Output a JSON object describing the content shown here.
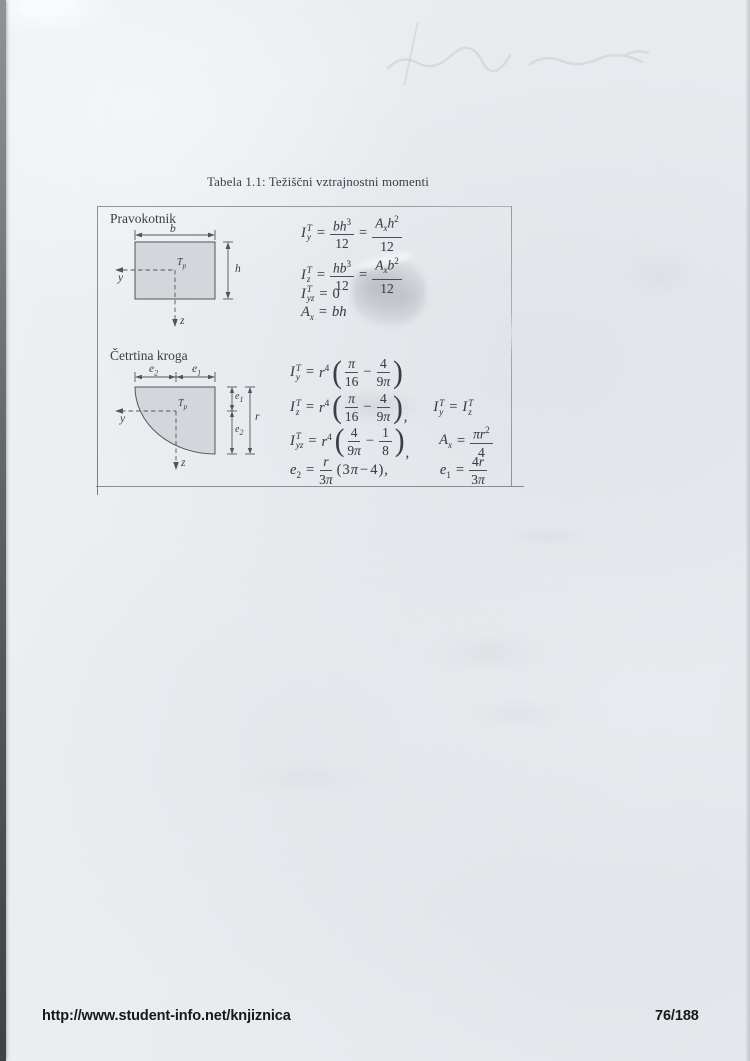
{
  "page": {
    "title": "Tabela 1.1: Težiščni vztrajnostni momenti",
    "footer": {
      "url": "http://www.student-info.net/knjiznica",
      "page_number": "76/188"
    }
  },
  "colors": {
    "paper": "#eaedf0",
    "ink": "#3a3e46",
    "footer-ink": "#16181b",
    "shape-fill": "#d3d6da",
    "shape-stroke": "#51555c",
    "table-border": "#9aa1a8"
  },
  "sym": {
    "eq": "=",
    "minus": "−",
    "lp": "(",
    "rp": ")",
    "comma": ","
  },
  "rect": {
    "label": "Pravokotnik",
    "diagram": {
      "dim_b": "b",
      "dim_h": "h",
      "axis_y": "y",
      "axis_z": "z",
      "centroid_base": "T",
      "centroid_sub": "p"
    },
    "f1": {
      "base": "I",
      "sup": "T",
      "sub": "y",
      "n1": "bh",
      "n1e": "3",
      "d1": "12",
      "n2a": "A",
      "n2as": "x",
      "n2b": "h",
      "n2e": "2",
      "d2": "12"
    },
    "f2": {
      "base": "I",
      "sup": "T",
      "sub": "z",
      "n1": "hb",
      "n1e": "3",
      "d1": "12",
      "n2a": "A",
      "n2as": "x",
      "n2b": "b",
      "n2e": "2",
      "d2": "12"
    },
    "f3": {
      "base": "I",
      "sup": "T",
      "sub": "yz",
      "rhs": "0"
    },
    "f4": {
      "base": "A",
      "sub": "x",
      "rhs": "bh"
    }
  },
  "quarter": {
    "label": "Četrtina kroga",
    "diagram": {
      "dim_e2_base": "e",
      "dim_e2_sub": "2",
      "dim_e1_base": "e",
      "dim_e1_sub": "1",
      "dim_r": "r",
      "axis_y": "y",
      "axis_z": "z",
      "centroid_base": "T",
      "centroid_sub": "p"
    },
    "g1": {
      "base": "I",
      "sup": "T",
      "sub": "y",
      "coef": "r",
      "coefe": "4",
      "n1": "π",
      "d1": "16",
      "n2": "4",
      "d2a": "9",
      "d2b": "π"
    },
    "g2": {
      "base": "I",
      "sup": "T",
      "sub": "z",
      "coef": "r",
      "coefe": "4",
      "n1": "π",
      "d1": "16",
      "n2": "4",
      "d2a": "9",
      "d2b": "π",
      "eq_base1": "I",
      "eq_sup1": "T",
      "eq_sub1": "y",
      "eq_base2": "I",
      "eq_sup2": "T",
      "eq_sub2": "z"
    },
    "g3": {
      "base": "I",
      "sup": "T",
      "sub": "yz",
      "coef": "r",
      "coefe": "4",
      "n1": "4",
      "d1a": "9",
      "d1b": "π",
      "n2": "1",
      "d2": "8",
      "a_base": "A",
      "a_sub": "x",
      "a_n1": "π",
      "a_n2": "r",
      "a_ne": "2",
      "a_d": "4"
    },
    "g4": {
      "base": "e",
      "base_sub": "2",
      "n1": "r",
      "d1a": "3",
      "d1b": "π",
      "t1": "3",
      "t2": "π",
      "t3": "4",
      "e1_base": "e",
      "e1_sub": "1",
      "n2a": "4",
      "n2b": "r",
      "d2a": "3",
      "d2b": "π"
    }
  }
}
